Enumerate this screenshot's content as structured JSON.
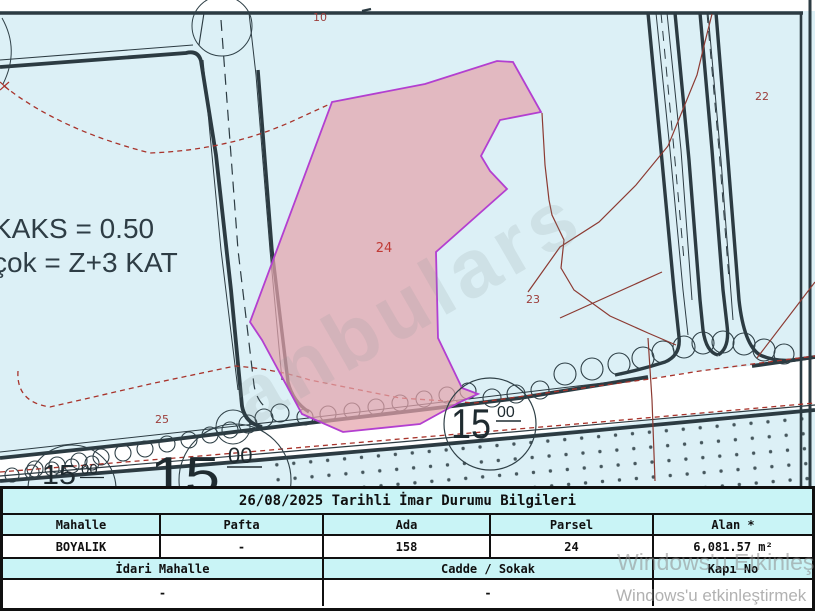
{
  "map": {
    "zoning_note": {
      "line1": "KAKS = 0.50",
      "line2": "çok = Z+3 KAT"
    },
    "parcel_labels": {
      "p10": "10",
      "p22": "22",
      "p23": "23",
      "p24": "24",
      "p25": "25"
    },
    "road_width_labels": {
      "left_small": {
        "value": "15",
        "sup": "00"
      },
      "left_big": {
        "value": "15",
        "sup": "00"
      },
      "right": {
        "value": "15",
        "sup": "00"
      }
    },
    "watermark_text": "anbulars",
    "colors": {
      "background": "#dcf0f6",
      "road_fill": "#ffffff",
      "line_dark": "#2c3b42",
      "cadastral_red": "#8c3a32",
      "dashed_red": "#a8332b",
      "parcel_fill": "#e5a4ac",
      "parcel_stroke": "#b33fd0",
      "label_red": "#9c3d3a",
      "table_header_bg": "#c9f4f6"
    }
  },
  "table": {
    "title": "26/08/2025 Tarihli İmar Durumu Bilgileri",
    "headers_row1": [
      "Mahalle",
      "Pafta",
      "Ada",
      "Parsel",
      "Alan *"
    ],
    "values_row1": [
      "BOYALIK",
      "-",
      "158",
      "24",
      "6,081.57 m²"
    ],
    "headers_row2": [
      "İdari Mahalle",
      "Cadde / Sokak",
      "Kapı No"
    ],
    "values_row2": [
      "-",
      "-",
      ""
    ]
  },
  "os_watermark": {
    "line1": "Windows'u Etkinleş",
    "line2": "Windows'u etkinleştirmek"
  }
}
